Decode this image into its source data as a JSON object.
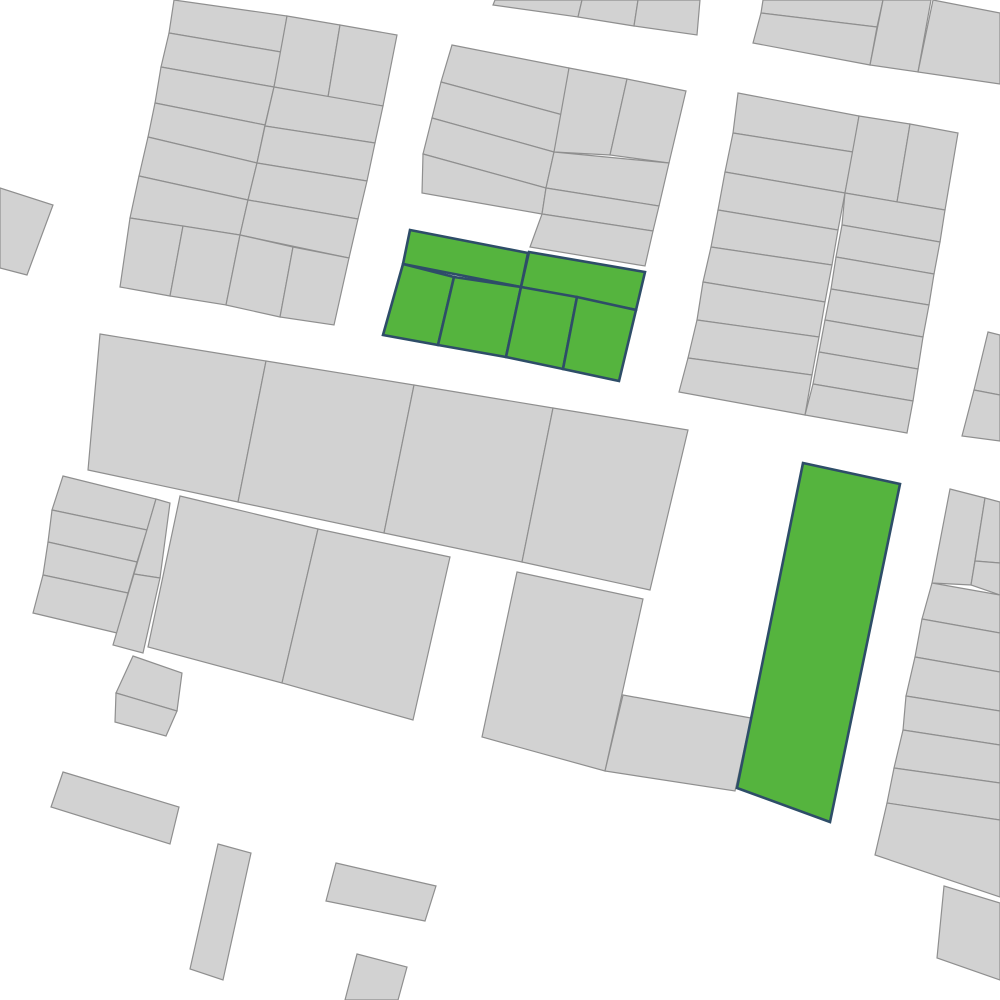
{
  "map": {
    "width": 1000,
    "height": 1000,
    "colors": {
      "background": "#ffffff",
      "parcel_fill": "#d2d2d2",
      "parcel_stroke": "#8f8f8f",
      "highlight_fill": "#55b43e",
      "highlight_stroke": "#2e4d68"
    },
    "stroke_widths": {
      "parcel": 1.2,
      "highlight": 2.6
    },
    "parcels": [
      {
        "id": "a-l1",
        "points": "174,0 287,16 281,52 169,33",
        "highlighted": false
      },
      {
        "id": "a-l2",
        "points": "169,33 281,52 274,87 161,67",
        "highlighted": false
      },
      {
        "id": "a-l3",
        "points": "161,67 274,87 265,125 155,103",
        "highlighted": false
      },
      {
        "id": "a-l4",
        "points": "155,103 265,125 257,163 148,137",
        "highlighted": false
      },
      {
        "id": "a-l5",
        "points": "148,137 257,163 248,200 139,176",
        "highlighted": false
      },
      {
        "id": "a-l6",
        "points": "139,176 248,200 240,235 130,218",
        "highlighted": false
      },
      {
        "id": "a-p1",
        "points": "287,16 340,25 328,97 274,87",
        "highlighted": false
      },
      {
        "id": "a-p2",
        "points": "340,25 397,35 383,106 328,97",
        "highlighted": false
      },
      {
        "id": "a-r1",
        "points": "274,87 383,106 375,143 265,126",
        "highlighted": false
      },
      {
        "id": "a-r2",
        "points": "265,126 375,143 367,181 257,163",
        "highlighted": false
      },
      {
        "id": "a-r3",
        "points": "257,163 367,181 358,219 248,200",
        "highlighted": false
      },
      {
        "id": "a-r4",
        "points": "248,200 358,219 349,258 240,235",
        "highlighted": false
      },
      {
        "id": "a-b1",
        "points": "130,218 183,226 170,296 120,287",
        "highlighted": false
      },
      {
        "id": "a-b2",
        "points": "183,226 240,235 226,305 170,296",
        "highlighted": false
      },
      {
        "id": "a-b3",
        "points": "240,235 293,247 280,317 226,305",
        "highlighted": false
      },
      {
        "id": "a-b4",
        "points": "293,247 349,258 334,325 280,317",
        "highlighted": false
      },
      {
        "id": "a2-1",
        "points": "495,0 582,0 578,17 493,5",
        "highlighted": false
      },
      {
        "id": "a2-2",
        "points": "582,0 638,0 634,26 578,17",
        "highlighted": false
      },
      {
        "id": "a2-3",
        "points": "638,0 700,0 697,35 634,26",
        "highlighted": false
      },
      {
        "id": "b-l1",
        "points": "452,45 569,68 563,115 441,82",
        "highlighted": false
      },
      {
        "id": "b-l2",
        "points": "441,82 563,115 554,152 432,118",
        "highlighted": false
      },
      {
        "id": "b-l3",
        "points": "432,118 554,152 546,188 423,154",
        "highlighted": false
      },
      {
        "id": "b-l4",
        "points": "423,154 546,188 542,214 422,193",
        "highlighted": false
      },
      {
        "id": "b-t1",
        "points": "569,68 627,79 610,155 554,152",
        "highlighted": false
      },
      {
        "id": "b-t2",
        "points": "627,79 686,91 669,163 610,155",
        "highlighted": false
      },
      {
        "id": "b-r1",
        "points": "554,152 669,163 659,206 546,188",
        "highlighted": false
      },
      {
        "id": "b-r2",
        "points": "546,188 659,206 653,231 542,214",
        "highlighted": false
      },
      {
        "id": "b-r3",
        "points": "542,214 653,231 645,266 530,247",
        "highlighted": false
      },
      {
        "id": "c-1",
        "points": "763,0 883,0 877,27 761,13",
        "highlighted": false
      },
      {
        "id": "c-2",
        "points": "761,13 877,27 870,65 753,43",
        "highlighted": false
      },
      {
        "id": "c-3",
        "points": "883,0 931,0 918,72 870,65",
        "highlighted": false
      },
      {
        "id": "c-4",
        "points": "933,0 1000,13 1000,84 918,72",
        "highlighted": false
      },
      {
        "id": "d-l1",
        "points": "738,93 859,116 853,152 733,133",
        "highlighted": false
      },
      {
        "id": "d-l2",
        "points": "733,133 853,152 845,193 725,172",
        "highlighted": false
      },
      {
        "id": "d-l3",
        "points": "725,172 845,193 838,230 718,210",
        "highlighted": false
      },
      {
        "id": "d-l4",
        "points": "718,210 838,230 832,265 711,247",
        "highlighted": false
      },
      {
        "id": "d-l5",
        "points": "711,247 832,265 825,302 703,282",
        "highlighted": false
      },
      {
        "id": "d-l6",
        "points": "703,282 825,302 819,337 697,320",
        "highlighted": false
      },
      {
        "id": "d-l7",
        "points": "697,320 819,337 812,375 688,358",
        "highlighted": false
      },
      {
        "id": "d-l8",
        "points": "688,358 812,375 805,415 679,392",
        "highlighted": false
      },
      {
        "id": "d-t1",
        "points": "859,116 910,124 897,202 845,193",
        "highlighted": false
      },
      {
        "id": "d-t2",
        "points": "910,124 958,133 945,210 897,202",
        "highlighted": false
      },
      {
        "id": "d-r1",
        "points": "845,193 945,210 940,242 842,225",
        "highlighted": false
      },
      {
        "id": "d-r2",
        "points": "842,225 940,242 934,274 836,257",
        "highlighted": false
      },
      {
        "id": "d-r3",
        "points": "836,257 934,274 929,305 831,289",
        "highlighted": false
      },
      {
        "id": "d-r4",
        "points": "831,289 929,305 923,337 825,320",
        "highlighted": false
      },
      {
        "id": "d-r5",
        "points": "825,320 923,337 918,369 819,352",
        "highlighted": false
      },
      {
        "id": "d-r6",
        "points": "819,352 918,369 913,401 813,384",
        "highlighted": false
      },
      {
        "id": "d-r7",
        "points": "813,384 913,401 907,433 805,415",
        "highlighted": false
      },
      {
        "id": "o-1",
        "points": "988,332 1000,335 1000,395 974,390",
        "highlighted": false
      },
      {
        "id": "o-2",
        "points": "974,390 1000,395 1000,441 962,436",
        "highlighted": false
      },
      {
        "id": "e-1",
        "points": "100,334 266,361 238,502 88,470",
        "highlighted": false
      },
      {
        "id": "e-2",
        "points": "266,361 414,385 384,533 238,502",
        "highlighted": false
      },
      {
        "id": "e-3",
        "points": "414,385 553,408 522,562 384,533",
        "highlighted": false
      },
      {
        "id": "e-4",
        "points": "553,408 688,430 650,590 522,562",
        "highlighted": false
      },
      {
        "id": "h-1",
        "points": "63,476 156,499 147,530 52,510",
        "highlighted": false
      },
      {
        "id": "h-2",
        "points": "52,510 147,530 137,562 48,542",
        "highlighted": false
      },
      {
        "id": "h-3",
        "points": "48,542 137,562 128,593 43,575",
        "highlighted": false
      },
      {
        "id": "h-4",
        "points": "43,575 128,593 117,633 33,613",
        "highlighted": false
      },
      {
        "id": "h-n1",
        "points": "156,499 170,503 160,578 134,574",
        "highlighted": false
      },
      {
        "id": "h-n2",
        "points": "134,574 160,578 143,653 113,645",
        "highlighted": false
      },
      {
        "id": "h2-a",
        "points": "133,656 182,673 177,711 116,693",
        "highlighted": false
      },
      {
        "id": "h2-b",
        "points": "116,693 177,711 166,736 115,722",
        "highlighted": false
      },
      {
        "id": "g-1",
        "points": "180,496 318,529 282,683 148,647",
        "highlighted": false
      },
      {
        "id": "g-2",
        "points": "318,529 450,557 413,720 282,683",
        "highlighted": false
      },
      {
        "id": "j-1",
        "points": "517,572 643,599 605,771 482,737",
        "highlighted": false
      },
      {
        "id": "j-2",
        "points": "623,695 751,718 735,791 605,771",
        "highlighted": false
      },
      {
        "id": "f-1",
        "points": "950,489 985,498 971,585 932,583",
        "highlighted": false
      },
      {
        "id": "f-2a",
        "points": "985,498 1000,502 1000,563 975,561",
        "highlighted": false
      },
      {
        "id": "f-2b",
        "points": "975,561 1000,563 1000,595 971,585",
        "highlighted": false
      },
      {
        "id": "f-3",
        "points": "932,583 1000,595 1000,633 922,619",
        "highlighted": false
      },
      {
        "id": "f-4",
        "points": "922,619 1000,633 1000,672 915,657",
        "highlighted": false
      },
      {
        "id": "f-5",
        "points": "915,657 1000,672 1000,711 906,696",
        "highlighted": false
      },
      {
        "id": "f-6",
        "points": "906,696 1000,711 1000,745 903,730",
        "highlighted": false
      },
      {
        "id": "f-7",
        "points": "903,730 1000,745 1000,783 894,768",
        "highlighted": false
      },
      {
        "id": "f-8",
        "points": "894,768 1000,783 1000,820 887,803",
        "highlighted": false
      },
      {
        "id": "f-9",
        "points": "887,803 1000,820 1000,897 875,855",
        "highlighted": false
      },
      {
        "id": "f-10",
        "points": "944,886 1000,903 1000,980 937,958",
        "highlighted": false
      },
      {
        "id": "l-1",
        "points": "0,188 53,205 27,275 0,268",
        "highlighted": false
      },
      {
        "id": "k-1",
        "points": "63,772 179,807 170,844 51,807",
        "highlighted": false
      },
      {
        "id": "k-2",
        "points": "218,844 251,853 223,980 190,969",
        "highlighted": false
      },
      {
        "id": "k-3",
        "points": "336,863 436,886 425,921 326,901",
        "highlighted": false
      },
      {
        "id": "k-4",
        "points": "357,954 407,967 398,1000 345,1000",
        "highlighted": false
      },
      {
        "id": "green-m1",
        "points": "410,230 528,253 521,287 403,264",
        "highlighted": true
      },
      {
        "id": "green-m2",
        "points": "529,252 645,272 636,310 521,287",
        "highlighted": true
      },
      {
        "id": "green-m3",
        "points": "403,264 454,277 438,345 383,335",
        "highlighted": true
      },
      {
        "id": "green-m4",
        "points": "454,277 521,287 506,357 438,345",
        "highlighted": true
      },
      {
        "id": "green-m5",
        "points": "521,287 577,297 563,369 506,357",
        "highlighted": true
      },
      {
        "id": "green-m6",
        "points": "577,297 636,310 619,381 563,369",
        "highlighted": true
      },
      {
        "id": "green-n1",
        "points": "803,463 900,484 830,822 737,788",
        "highlighted": true
      }
    ]
  }
}
